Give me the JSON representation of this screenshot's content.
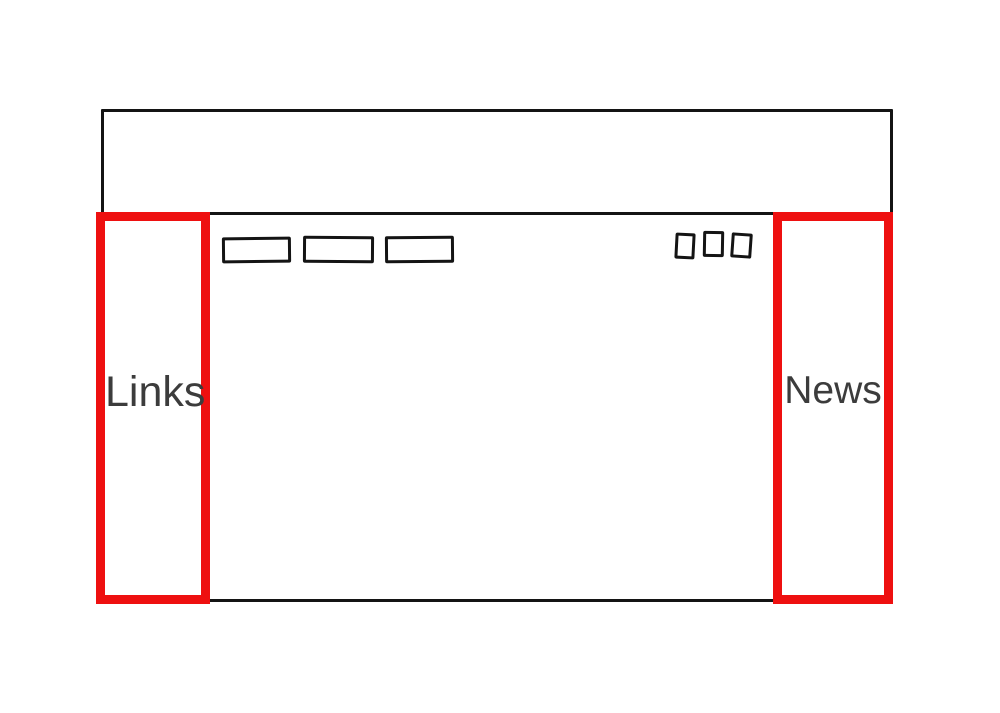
{
  "palette": {
    "background": "#ffffff",
    "line_black": "#141414",
    "annotation_red": "#ee1010",
    "label_gray": "#3c3c3c"
  },
  "wireframe": {
    "left_sidebar": {
      "label": "Links"
    },
    "right_sidebar": {
      "label": "News"
    }
  }
}
